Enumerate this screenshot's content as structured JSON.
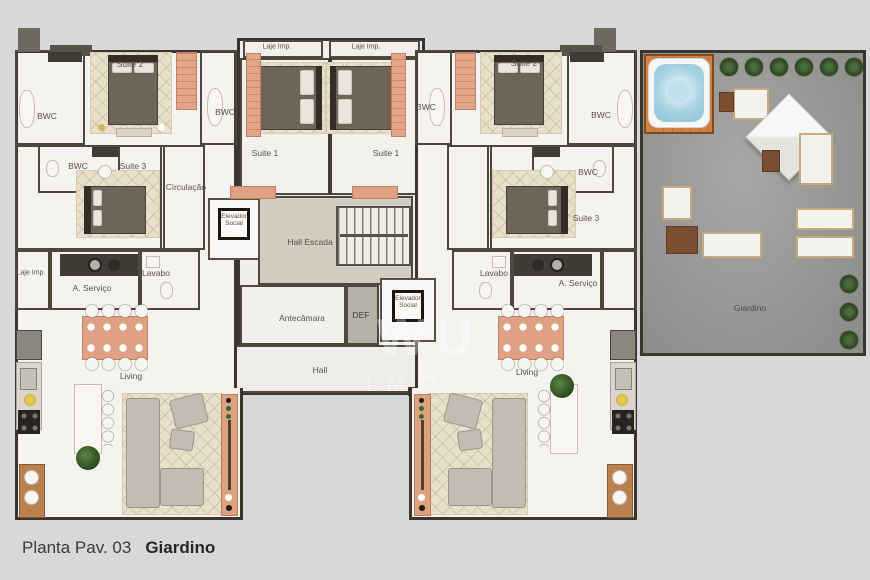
{
  "caption": {
    "prefix": "Planta Pav. 03",
    "highlight": "Giardino"
  },
  "watermark": {
    "line1": "WU",
    "line2": "IMÓ"
  },
  "labels": [
    {
      "id": "laje-imp-core-left",
      "text": "Laje Imp."
    },
    {
      "id": "laje-imp-core-right",
      "text": "Laje Imp."
    },
    {
      "id": "suite2-left",
      "text": "Suite 2"
    },
    {
      "id": "bwc-left-top",
      "text": "BWC"
    },
    {
      "id": "bwc-left-core",
      "text": "BWC"
    },
    {
      "id": "bwc-left-mid",
      "text": "BWC"
    },
    {
      "id": "suite3-left",
      "text": "Suite 3"
    },
    {
      "id": "circulacao-left",
      "text": "Circulação"
    },
    {
      "id": "suite1-left",
      "text": "Suite 1"
    },
    {
      "id": "suite1-right",
      "text": "Suite 1"
    },
    {
      "id": "bwc-right-core",
      "text": "BWC"
    },
    {
      "id": "suite2-right",
      "text": "Suite 2"
    },
    {
      "id": "bwc-right-top",
      "text": "BWC"
    },
    {
      "id": "bwc-right-mid",
      "text": "BWC"
    },
    {
      "id": "suite3-right",
      "text": "Suite 3"
    },
    {
      "id": "elevador-social-left",
      "text": "Elevador Social"
    },
    {
      "id": "hall-escada",
      "text": "Hall Escada"
    },
    {
      "id": "antecamara",
      "text": "Antecâmara"
    },
    {
      "id": "def",
      "text": "DEF"
    },
    {
      "id": "elevador-social-right",
      "text": "Elevador Social"
    },
    {
      "id": "hall",
      "text": "Hall"
    },
    {
      "id": "laje-imp-left",
      "text": "Laje Imp."
    },
    {
      "id": "aservico-left",
      "text": "A. Serviço"
    },
    {
      "id": "lavabo-left",
      "text": "Lavabo"
    },
    {
      "id": "living-left",
      "text": "Living"
    },
    {
      "id": "lavabo-right",
      "text": "Lavabo"
    },
    {
      "id": "aservico-right",
      "text": "A. Serviço"
    },
    {
      "id": "living-right",
      "text": "Living"
    },
    {
      "id": "giardino",
      "text": "Giardino"
    }
  ],
  "colors": {
    "background": "#d8d8d8",
    "wall": "#3a362f",
    "unit_floor": "#f4f3f0",
    "terrace_concrete": "#9c9c9a",
    "deck_wood": "#cc7f45",
    "hot_tub_water": "#a8d2e2",
    "accent_salmon": "#dfa083",
    "rug_beige": "#e8e0cb",
    "shrub_green": "#2c421f"
  }
}
